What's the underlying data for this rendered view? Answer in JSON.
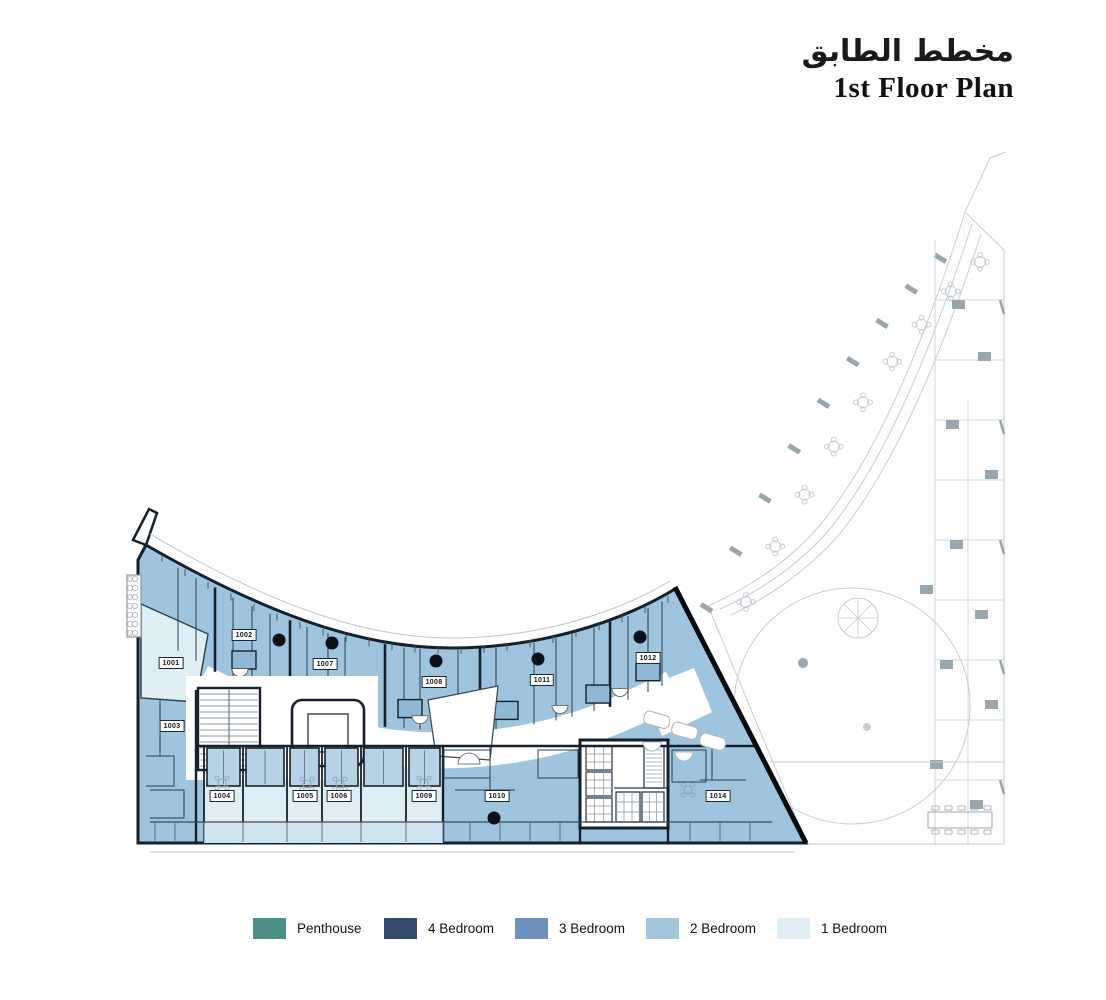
{
  "header": {
    "title_ar": "مخطط الطابق",
    "title_en": "1st Floor Plan"
  },
  "legend": {
    "items": [
      {
        "label": "Penthouse",
        "color": "#4a9089"
      },
      {
        "label": "4 Bedroom",
        "color": "#33496b"
      },
      {
        "label": "3 Bedroom",
        "color": "#6d90bc"
      },
      {
        "label": "2 Bedroom",
        "color": "#a2c6dd"
      },
      {
        "label": "1 Bedroom",
        "color": "#dfeef2"
      }
    ]
  },
  "plan": {
    "palette": {
      "two_bedroom_fill": "#9ec5dd",
      "one_bedroom_fill": "#dfeef3",
      "pod_fill": "#b7d2e4",
      "wall": "#15202c",
      "thin_wall": "#2c3d4c",
      "gray_line": "#c6cdd2",
      "gray_dark": "#9aa6ad",
      "balcony_tint": "#cfe4ef"
    },
    "units": [
      {
        "id": "1001",
        "type": "1 Bedroom",
        "x": 171,
        "y": 663
      },
      {
        "id": "1002",
        "type": "2 Bedroom",
        "x": 244,
        "y": 635
      },
      {
        "id": "1003",
        "type": "2 Bedroom",
        "x": 172,
        "y": 726
      },
      {
        "id": "1004",
        "type": "1 Bedroom",
        "x": 222,
        "y": 796
      },
      {
        "id": "1005",
        "type": "1 Bedroom",
        "x": 305,
        "y": 796
      },
      {
        "id": "1006",
        "type": "1 Bedroom",
        "x": 339,
        "y": 796
      },
      {
        "id": "1007",
        "type": "2 Bedroom",
        "x": 325,
        "y": 664
      },
      {
        "id": "1008",
        "type": "2 Bedroom",
        "x": 434,
        "y": 682
      },
      {
        "id": "1009",
        "type": "1 Bedroom",
        "x": 424,
        "y": 796
      },
      {
        "id": "1010",
        "type": "2 Bedroom",
        "x": 497,
        "y": 796
      },
      {
        "id": "1011",
        "type": "2 Bedroom",
        "x": 542,
        "y": 680
      },
      {
        "id": "1012",
        "type": "2 Bedroom",
        "x": 648,
        "y": 658
      },
      {
        "id": "1014",
        "type": "2 Bedroom",
        "x": 718,
        "y": 796
      }
    ]
  }
}
